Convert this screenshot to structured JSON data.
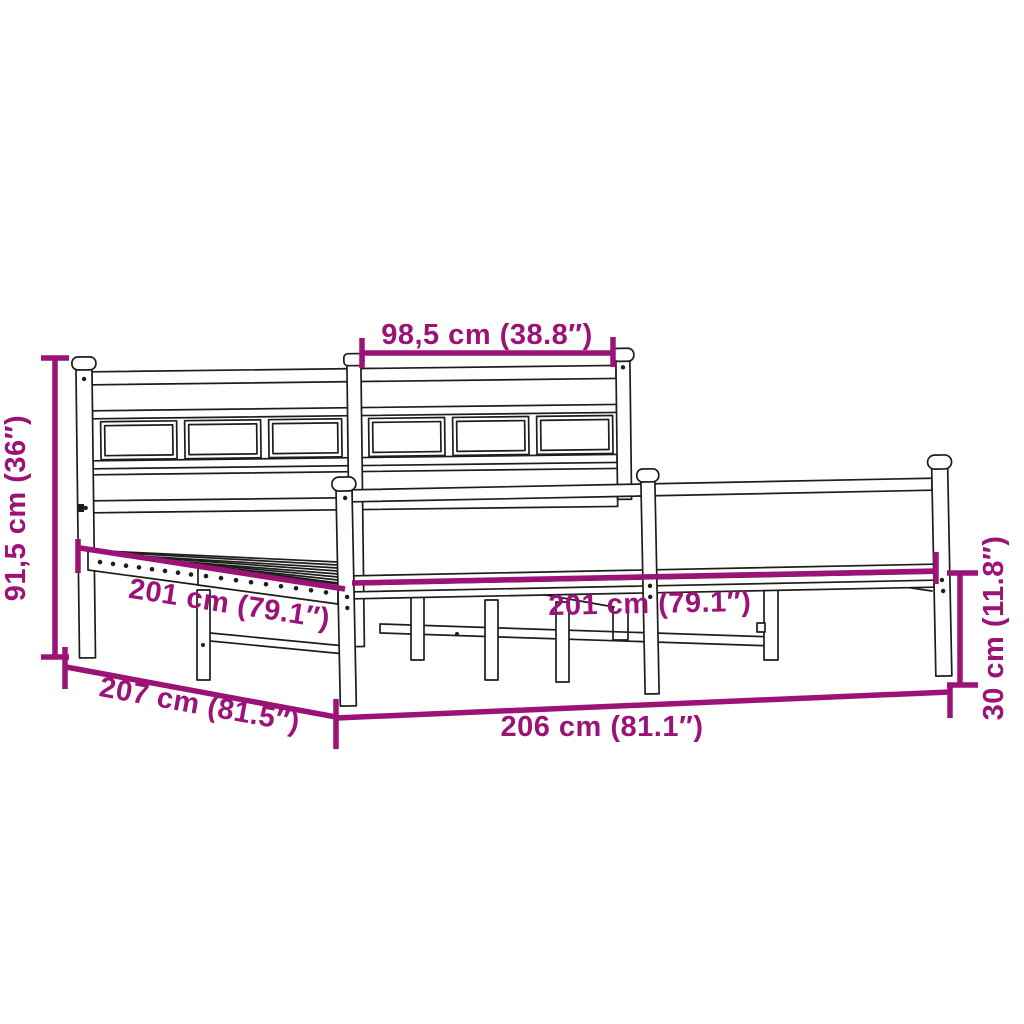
{
  "diagram": {
    "subject": "metal-bed-frame-with-headboard-and-footboard",
    "accent_color": "#9C1377",
    "line_color": "#1D1D1B",
    "background_color": "#FFFFFF",
    "dimensions": [
      {
        "id": "headboard-section-width",
        "label": "98,5 cm (38.8″)",
        "cm": "98,5",
        "inches": "38.8″",
        "placement": "top-horizontal"
      },
      {
        "id": "headboard-height",
        "label": "91,5 cm (36″)",
        "cm": "91,5",
        "inches": "36″",
        "placement": "left-vertical"
      },
      {
        "id": "slat-base-length-left",
        "label": "201 cm (79.1″)",
        "cm": "201",
        "inches": "79.1″",
        "placement": "left-diagonal"
      },
      {
        "id": "slat-base-length-right",
        "label": "201 cm (79.1″)",
        "cm": "201",
        "inches": "79.1″",
        "placement": "right-horizontal"
      },
      {
        "id": "overall-length",
        "label": "207 cm (81.5″)",
        "cm": "207",
        "inches": "81.5″",
        "placement": "bottom-left-diagonal"
      },
      {
        "id": "overall-width",
        "label": "206 cm (81.1″)",
        "cm": "206",
        "inches": "81.1″",
        "placement": "bottom-horizontal"
      },
      {
        "id": "frame-height",
        "label": "30 cm (11.8″)",
        "cm": "30",
        "inches": "11.8″",
        "placement": "right-vertical"
      }
    ]
  }
}
